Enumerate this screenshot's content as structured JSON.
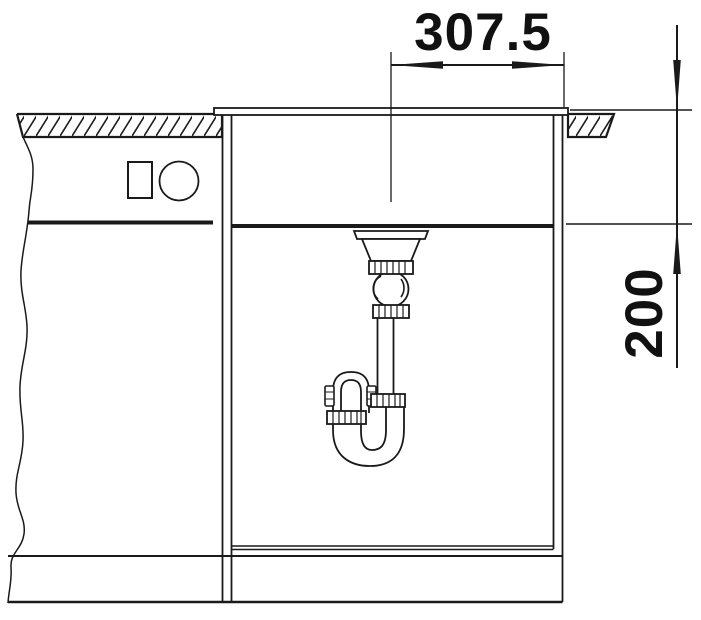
{
  "drawing": {
    "type": "sink-installation-section-drawing",
    "colors": {
      "line": "#1a1a1a",
      "background": "#ffffff"
    },
    "dimensions": {
      "horizontal": {
        "label": "307.5"
      },
      "vertical": {
        "label": "200"
      }
    }
  }
}
